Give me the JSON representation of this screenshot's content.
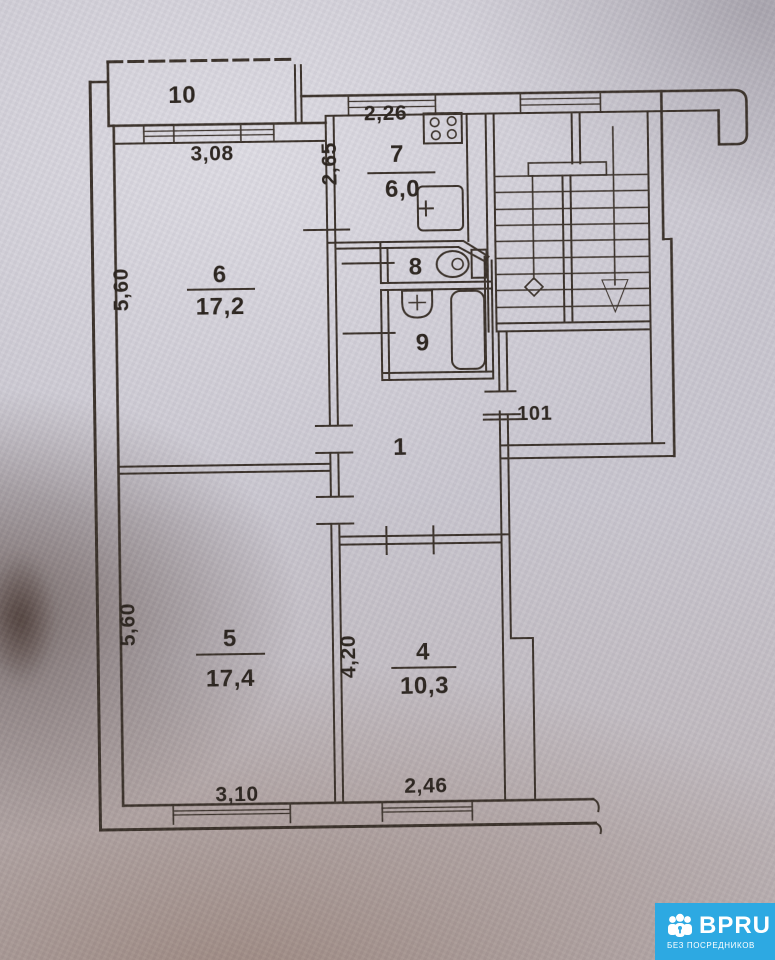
{
  "plan_title": "apartment floor plan (scanned)",
  "rooms": {
    "r1": {
      "number": "1"
    },
    "r4": {
      "number": "4",
      "area": "10,3"
    },
    "r5": {
      "number": "5",
      "area": "17,4"
    },
    "r6": {
      "number": "6",
      "area": "17,2"
    },
    "r7": {
      "number": "7",
      "area": "6,0"
    },
    "r8": {
      "number": "8"
    },
    "r9": {
      "number": "9"
    },
    "r10": {
      "number": "10"
    },
    "r101": {
      "number": "101"
    }
  },
  "dims": {
    "balcony_width": "3,08",
    "kitchen_width": "2,26",
    "kitchen_depth": "2,65",
    "room6_depth": "5,60",
    "room5_depth": "5,60",
    "room4_depth": "4,20",
    "room5_window": "3,10",
    "room4_window": "2,46"
  },
  "logo": {
    "brand": "BPRU",
    "tagline": "БЕЗ ПОСРЕДНИКОВ",
    "bg_color": "#2da9e2"
  },
  "colors": {
    "paper": "#cac7d0",
    "ink": "#3a3129"
  }
}
